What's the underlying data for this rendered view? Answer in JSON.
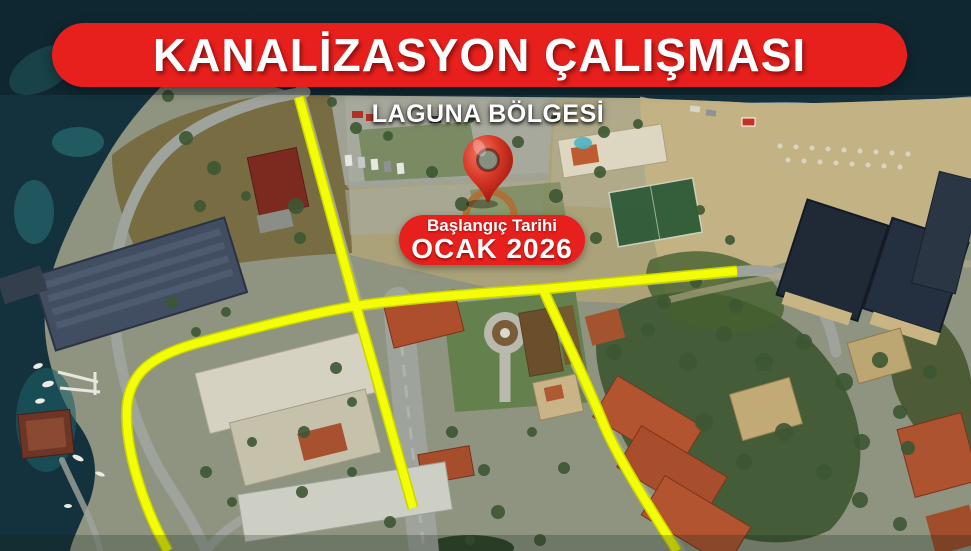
{
  "banner": {
    "title": "KANALİZASYON ÇALIŞMASI",
    "bg_color": "#e8201d",
    "text_color": "#ffffff"
  },
  "location": {
    "region_label": "LAGUNA BÖLGESİ",
    "pin_color": "#d23420"
  },
  "start_date": {
    "label": "Başlangıç Tarihi",
    "value": "OCAK 2026",
    "bg_color": "#e8201d",
    "text_color": "#ffffff"
  },
  "map": {
    "type": "satellite-aerial",
    "route_color": "#f2fd06",
    "route_casing_color": "#c9d400",
    "routes": [
      {
        "name": "north-approach-line",
        "d": "M299,97 L356,306"
      },
      {
        "name": "shore-curve-line",
        "d": "M168,551 C146,512 124,452 127,406 C130,374 150,357 194,344 C252,328 318,312 356,306 C402,299 482,293 543,289 L737,271"
      },
      {
        "name": "central-avenue-line",
        "d": "M356,306 C372,360 394,440 413,508"
      },
      {
        "name": "southeast-branch-line",
        "d": "M543,289 C566,340 588,385 604,425 C620,462 650,508 677,551"
      }
    ]
  }
}
